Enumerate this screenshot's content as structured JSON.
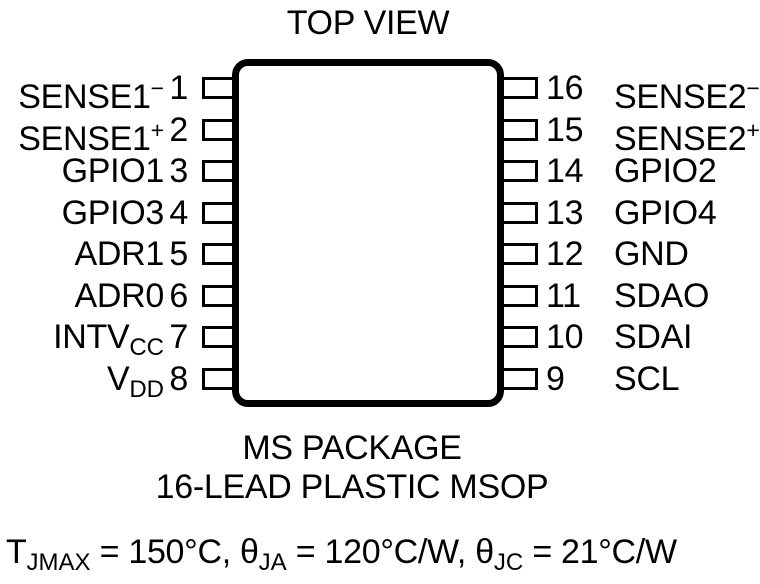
{
  "title": "TOP VIEW",
  "ic": {
    "left_pins": [
      {
        "number": "1",
        "base": "SENSE1",
        "sup": "−"
      },
      {
        "number": "2",
        "base": "SENSE1",
        "sup": "+"
      },
      {
        "number": "3",
        "base": "GPIO1"
      },
      {
        "number": "4",
        "base": "GPIO3"
      },
      {
        "number": "5",
        "base": "ADR1"
      },
      {
        "number": "6",
        "base": "ADR0"
      },
      {
        "number": "7",
        "base": "INTV",
        "sub": "CC"
      },
      {
        "number": "8",
        "base": "V",
        "sub": "DD"
      }
    ],
    "right_pins": [
      {
        "number": "16",
        "base": "SENSE2",
        "sup": "−"
      },
      {
        "number": "15",
        "base": "SENSE2",
        "sup": "+"
      },
      {
        "number": "14",
        "base": "GPIO2"
      },
      {
        "number": "13",
        "base": "GPIO4"
      },
      {
        "number": "12",
        "base": "GND"
      },
      {
        "number": "11",
        "base": "SDAO"
      },
      {
        "number": "10",
        "base": "SDAI"
      },
      {
        "number": "9",
        "base": "SCL"
      }
    ]
  },
  "package": {
    "line1": "MS PACKAGE",
    "line2": "16-LEAD PLASTIC MSOP"
  },
  "thermal": {
    "t_base": "T",
    "t_sub": "JMAX",
    "t_rest": " = 150°C, ",
    "ja_base": "θ",
    "ja_sub": "JA",
    "ja_rest": " = 120°C/W, ",
    "jc_base": "θ",
    "jc_sub": "JC",
    "jc_rest": " = 21°C/W"
  },
  "colors": {
    "ink": "#000000",
    "background": "#ffffff"
  }
}
